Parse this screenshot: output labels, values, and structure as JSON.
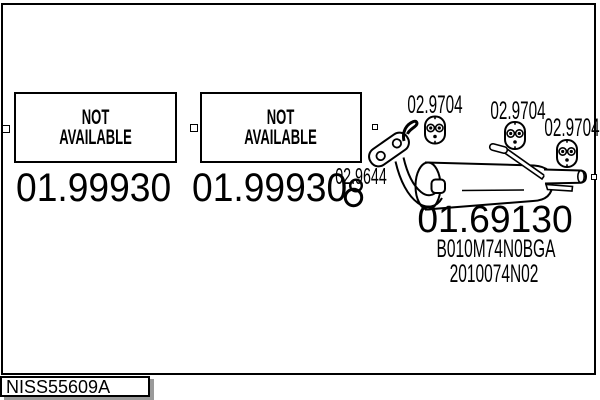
{
  "colors": {
    "ink": "#000000",
    "paper": "#ffffff",
    "tab_shadow": "#9a9a9a"
  },
  "items": {
    "placeholder_1": {
      "line1": "NOT",
      "line2": "AVAILABLE",
      "part_number": "01.99930"
    },
    "placeholder_2": {
      "line1": "NOT",
      "line2": "AVAILABLE",
      "part_number": "01.99930"
    },
    "muffler": {
      "part_number": "01.69130",
      "oem_ref_1": "B010M74N0BGA",
      "oem_ref_2": "2010074N02",
      "gasket_part_number": "02.9644",
      "hanger_part_numbers": [
        "02.9704",
        "02.9704",
        "02.9704"
      ]
    }
  },
  "footer": {
    "drawing_code": "NISS55609A"
  },
  "icons": {
    "rubber_hanger": "rubber-hanger-icon",
    "gasket_rings": "gasket-rings-icon",
    "flange": "flange-icon",
    "selection_handle": "selection-handle"
  }
}
